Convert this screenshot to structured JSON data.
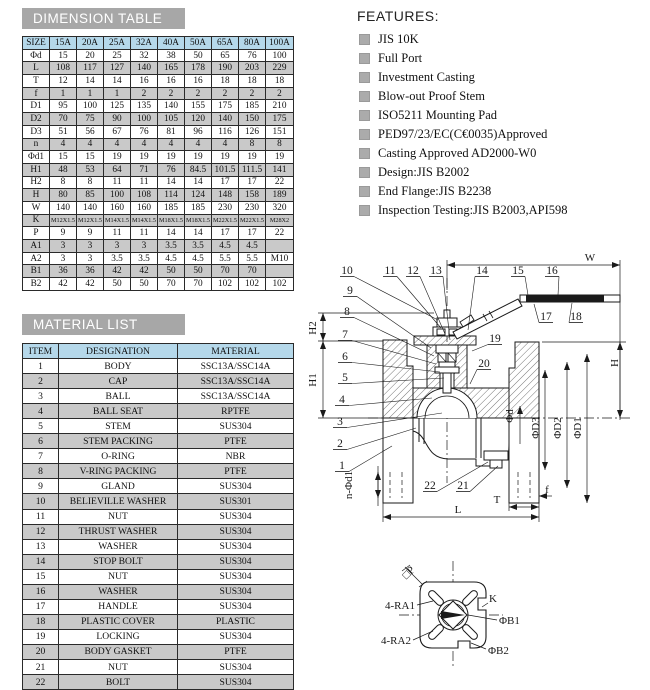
{
  "titles": {
    "dimension_table": "DIMENSION TABLE",
    "material_list": "MATERIAL LIST"
  },
  "dimension_table": {
    "header": [
      "SIZE",
      "15A",
      "20A",
      "25A",
      "32A",
      "40A",
      "50A",
      "65A",
      "80A",
      "100A"
    ],
    "rows": [
      {
        "label": "Φd",
        "values": [
          "15",
          "20",
          "25",
          "32",
          "38",
          "50",
          "65",
          "76",
          "100"
        ]
      },
      {
        "label": "L",
        "values": [
          "108",
          "117",
          "127",
          "140",
          "165",
          "178",
          "190",
          "203",
          "229"
        ]
      },
      {
        "label": "T",
        "values": [
          "12",
          "14",
          "14",
          "16",
          "16",
          "16",
          "18",
          "18",
          "18"
        ]
      },
      {
        "label": "f",
        "values": [
          "1",
          "1",
          "1",
          "2",
          "2",
          "2",
          "2",
          "2",
          "2"
        ]
      },
      {
        "label": "D1",
        "values": [
          "95",
          "100",
          "125",
          "135",
          "140",
          "155",
          "175",
          "185",
          "210"
        ]
      },
      {
        "label": "D2",
        "values": [
          "70",
          "75",
          "90",
          "100",
          "105",
          "120",
          "140",
          "150",
          "175"
        ]
      },
      {
        "label": "D3",
        "values": [
          "51",
          "56",
          "67",
          "76",
          "81",
          "96",
          "116",
          "126",
          "151"
        ]
      },
      {
        "label": "n",
        "values": [
          "4",
          "4",
          "4",
          "4",
          "4",
          "4",
          "4",
          "8",
          "8"
        ]
      },
      {
        "label": "Φd1",
        "values": [
          "15",
          "15",
          "19",
          "19",
          "19",
          "19",
          "19",
          "19",
          "19"
        ]
      },
      {
        "label": "H1",
        "values": [
          "48",
          "53",
          "64",
          "71",
          "76",
          "84.5",
          "101.5",
          "111.5",
          "141"
        ]
      },
      {
        "label": "H2",
        "values": [
          "8",
          "8",
          "11",
          "11",
          "14",
          "14",
          "17",
          "17",
          "22"
        ]
      },
      {
        "label": "H",
        "values": [
          "80",
          "85",
          "100",
          "108",
          "114",
          "124",
          "148",
          "158",
          "189"
        ]
      },
      {
        "label": "W",
        "values": [
          "140",
          "140",
          "160",
          "160",
          "185",
          "185",
          "230",
          "230",
          "320"
        ]
      },
      {
        "label": "K",
        "values": [
          "M12X1.5",
          "M12X1.5",
          "M14X1.5",
          "M14X1.5",
          "M18X1.5",
          "M18X1.5",
          "M22X1.5",
          "M22X1.5",
          "M28X2"
        ]
      },
      {
        "label": "P",
        "values": [
          "9",
          "9",
          "11",
          "11",
          "14",
          "14",
          "17",
          "17",
          "22"
        ]
      },
      {
        "label": "A1",
        "values": [
          "3",
          "3",
          "3",
          "3",
          "3.5",
          "3.5",
          "4.5",
          "4.5",
          ""
        ]
      },
      {
        "label": "A2",
        "values": [
          "3",
          "3",
          "3.5",
          "3.5",
          "4.5",
          "4.5",
          "5.5",
          "5.5",
          "M10"
        ]
      },
      {
        "label": "B1",
        "values": [
          "36",
          "36",
          "42",
          "42",
          "50",
          "50",
          "70",
          "70",
          ""
        ]
      },
      {
        "label": "B2",
        "values": [
          "42",
          "42",
          "50",
          "50",
          "70",
          "70",
          "102",
          "102",
          "102"
        ]
      }
    ]
  },
  "material_list": {
    "header": [
      "ITEM",
      "DESIGNATION",
      "MATERIAL"
    ],
    "rows": [
      [
        "1",
        "BODY",
        "SSC13A/SSC14A"
      ],
      [
        "2",
        "CAP",
        "SSC13A/SSC14A"
      ],
      [
        "3",
        "BALL",
        "SSC13A/SSC14A"
      ],
      [
        "4",
        "BALL SEAT",
        "RPTFE"
      ],
      [
        "5",
        "STEM",
        "SUS304"
      ],
      [
        "6",
        "STEM PACKING",
        "PTFE"
      ],
      [
        "7",
        "O-RING",
        "NBR"
      ],
      [
        "8",
        "V-RING PACKING",
        "PTFE"
      ],
      [
        "9",
        "GLAND",
        "SUS304"
      ],
      [
        "10",
        "BELIEVILLE WASHER",
        "SUS301"
      ],
      [
        "11",
        "NUT",
        "SUS304"
      ],
      [
        "12",
        "THRUST WASHER",
        "SUS304"
      ],
      [
        "13",
        "WASHER",
        "SUS304"
      ],
      [
        "14",
        "STOP BOLT",
        "SUS304"
      ],
      [
        "15",
        "NUT",
        "SUS304"
      ],
      [
        "16",
        "WASHER",
        "SUS304"
      ],
      [
        "17",
        "HANDLE",
        "SUS304"
      ],
      [
        "18",
        "PLASTIC COVER",
        "PLASTIC"
      ],
      [
        "19",
        "LOCKING",
        "SUS304"
      ],
      [
        "20",
        "BODY GASKET",
        "PTFE"
      ],
      [
        "21",
        "NUT",
        "SUS304"
      ],
      [
        "22",
        "BOLT",
        "SUS304"
      ]
    ]
  },
  "features": {
    "title": "FEATURES:",
    "items": [
      "JIS 10K",
      "Full Port",
      "Investment Casting",
      "Blow-out Proof Stem",
      "ISO5211 Mounting Pad",
      "PED97/23/EC(C€0035)Approved",
      "Casting Approved AD2000-W0",
      "Design:JIS B2002",
      "End Flange:JIS B2238",
      "Inspection Testing:JIS B2003,API598"
    ]
  },
  "drawing": {
    "callouts": [
      "10",
      "11",
      "12",
      "13",
      "14",
      "15",
      "16",
      "17",
      "18",
      "19",
      "20",
      "9",
      "8",
      "7",
      "6",
      "5",
      "4",
      "3",
      "2",
      "1",
      "22",
      "21"
    ],
    "dims": {
      "w": "W",
      "h": "H",
      "h1": "H1",
      "h2": "H2",
      "l": "L",
      "t": "T",
      "f": "f",
      "d": "Φd",
      "d3": "ΦD3",
      "d2": "ΦD2",
      "d1": "ΦD1",
      "nd1": "n-Φd1"
    },
    "pad": {
      "p": "□P",
      "ra1": "4-RA1",
      "ra2": "4-RA2",
      "k": "K",
      "b1": "ΦB1",
      "b2": "ΦB2"
    }
  },
  "colors": {
    "title_bar": "#a7a7a7",
    "table_header": "#b5d8ea",
    "alt_row": "#c9c9c9",
    "line": "#1a1a1a"
  }
}
